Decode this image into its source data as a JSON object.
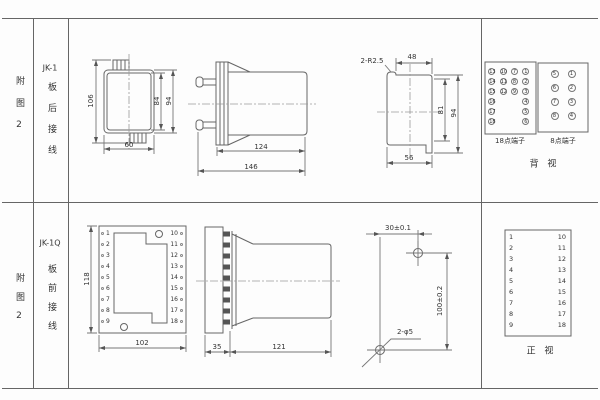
{
  "row1": {
    "figure_label": "附图2",
    "model": "JK-1",
    "wiring": "板后接线",
    "front_view": {
      "total_height": "106",
      "inner_height": "84",
      "outer_height": "94",
      "width": "60"
    },
    "side_view": {
      "body_length": "124",
      "total_length": "146"
    },
    "cutout": {
      "corner_note": "2-R2.5",
      "top_width": "48",
      "inner_height": "81",
      "outer_height": "94",
      "bottom_width": "56"
    },
    "terminals18": {
      "label": "18点端子",
      "rows": [
        [
          "13",
          "10",
          "7",
          "1"
        ],
        [
          "14",
          "11",
          "8",
          "2"
        ],
        [
          "15",
          "12",
          "9",
          "3"
        ],
        [
          "16",
          "4"
        ],
        [
          "17",
          "5"
        ],
        [
          "18",
          "6"
        ]
      ]
    },
    "terminals8": {
      "label": "8点端子",
      "rows": [
        [
          "5",
          "1"
        ],
        [
          "6",
          "2"
        ],
        [
          "7",
          "3"
        ],
        [
          "8",
          "4"
        ]
      ]
    },
    "view_label": "背 视"
  },
  "row2": {
    "figure_label": "附图2",
    "model": "JK-1Q",
    "wiring": "板前接线",
    "front_view": {
      "height": "118",
      "width": "102",
      "left_terminals": [
        "1",
        "2",
        "3",
        "4",
        "5",
        "6",
        "7",
        "8",
        "9"
      ],
      "right_terminals": [
        "10",
        "11",
        "12",
        "13",
        "14",
        "15",
        "16",
        "17",
        "18"
      ]
    },
    "side_view": {
      "plate_depth": "35",
      "body_length": "121"
    },
    "drill": {
      "hole_spacing_h": "30±0.1",
      "hole_spacing_v": "100±0.2",
      "hole_note": "2-φ5"
    },
    "terminal_table": {
      "left": [
        "1",
        "2",
        "3",
        "4",
        "5",
        "6",
        "7",
        "8",
        "9"
      ],
      "right": [
        "10",
        "11",
        "12",
        "13",
        "14",
        "15",
        "16",
        "17",
        "18"
      ]
    },
    "view_label": "正 视"
  }
}
